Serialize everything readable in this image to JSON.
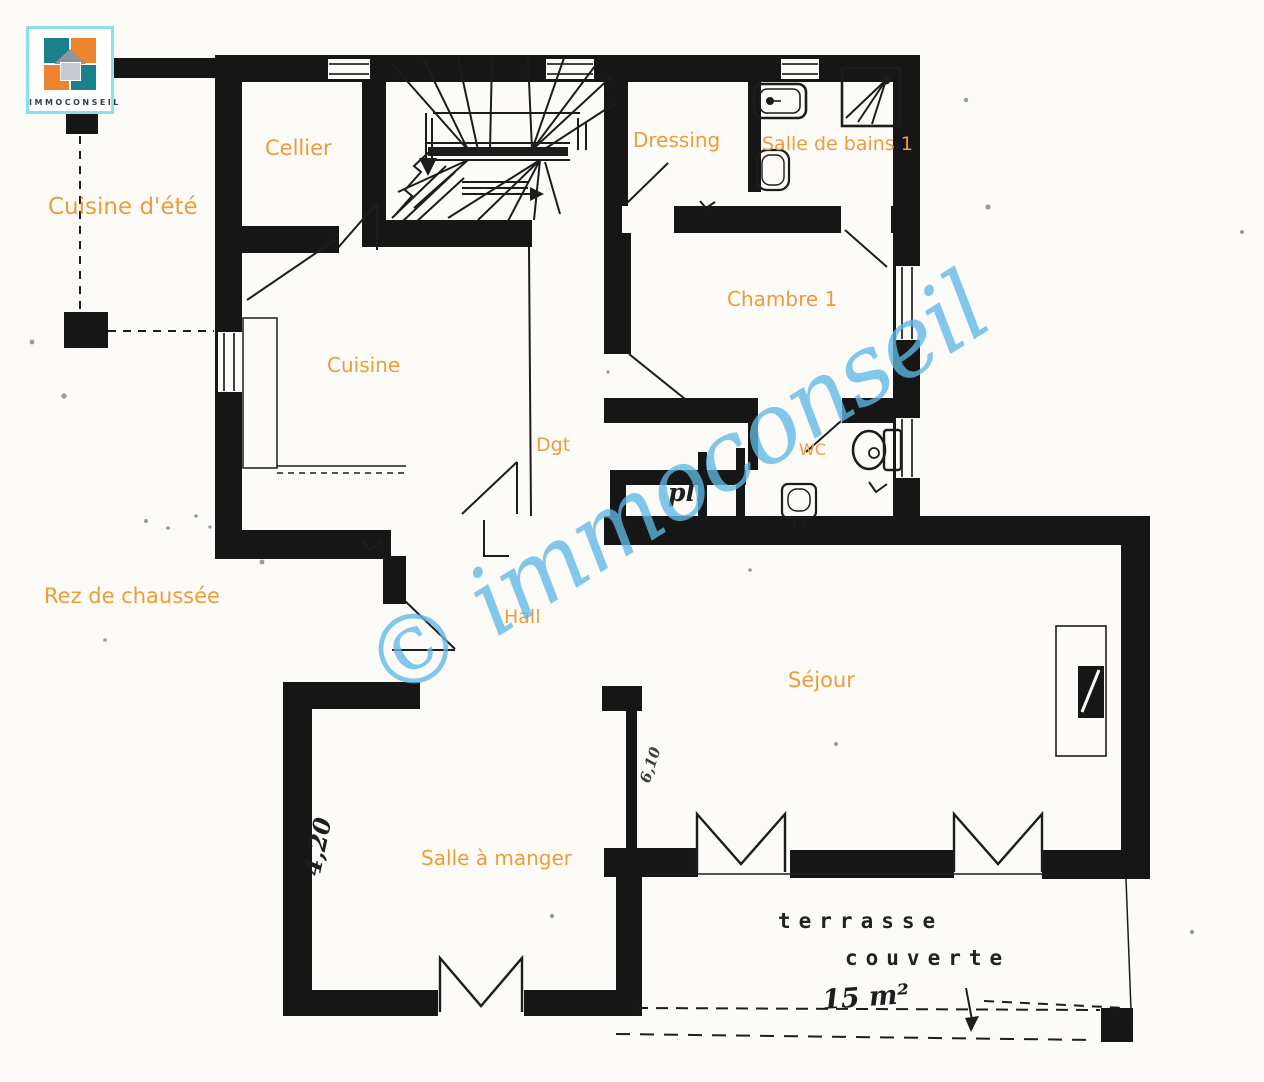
{
  "brand": {
    "name": "IMMOCONSEIL"
  },
  "floor": {
    "label": "Rez de chaussée"
  },
  "watermark": {
    "text": "© immoconseil"
  },
  "rooms": {
    "cuisine_ete": "Cuisine d'été",
    "cellier": "Cellier",
    "dressing": "Dressing",
    "salle_de_bains_1": "Salle de bains 1",
    "chambre_1": "Chambre 1",
    "cuisine": "Cuisine",
    "dgt": "Dgt",
    "wc": "WC",
    "pl": "pl.",
    "hall": "Hall",
    "sejour": "Séjour",
    "salle_a_manger": "Salle à manger"
  },
  "terrace": {
    "line1": "terrasse",
    "line2": "couverte",
    "area": "15 m²"
  },
  "handwritten": {
    "dim_left": "4,20",
    "dim_small": "6,10"
  },
  "colors": {
    "label_orange": "#ed9c3a",
    "watermark_blue": "#5fb8e5",
    "wall_black": "#161616",
    "logo_teal": "#1b7f8c",
    "logo_orange": "#ee8430",
    "logo_border": "#8ce0e6"
  }
}
